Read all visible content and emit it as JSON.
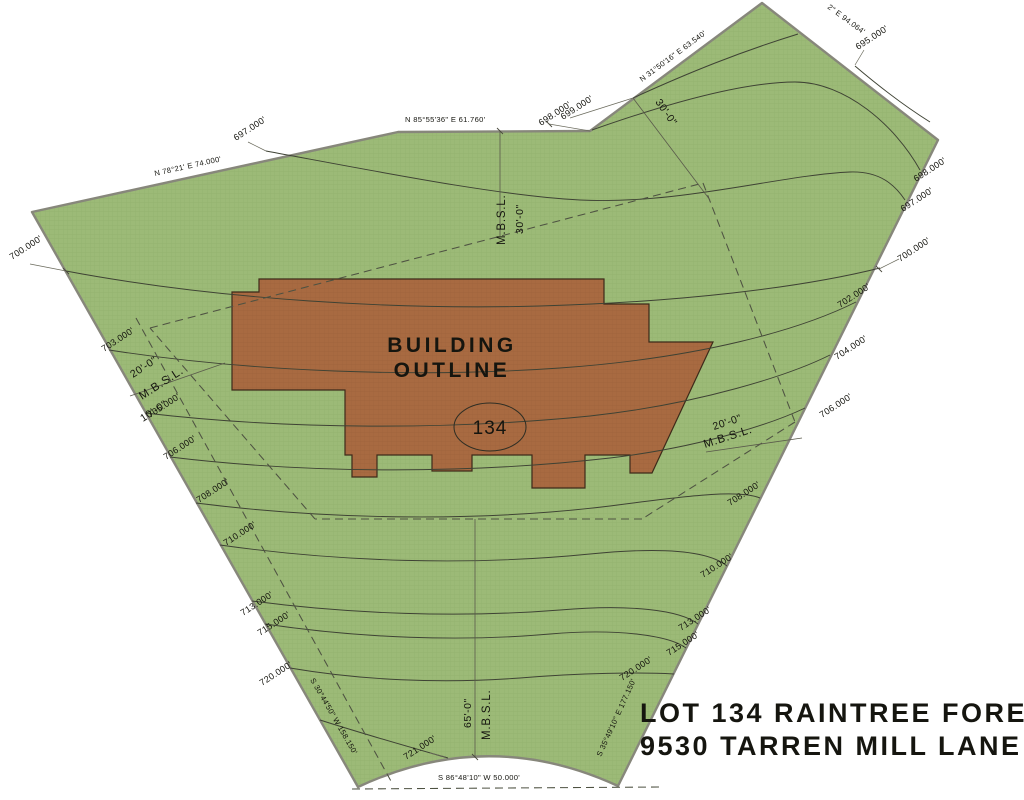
{
  "title": {
    "line1": "LOT 134 RAINTREE FOREST",
    "line2": "9530 TARREN MILL LANE"
  },
  "building": {
    "label_line1": "BUILDING",
    "label_line2": "OUTLINE",
    "lot_number": "134"
  },
  "bearings": {
    "top_left": "N 78°21' E 74.000'",
    "top": "N 85°55'36\" E 61.760'",
    "northeast": "N 31°50'16\" E 63.540'",
    "northeast2": "2\" E 94.064'",
    "right": "S 35°49'10\" E 177.150'",
    "left": "S 30°44'50\" W 158.150'",
    "bottom": "S 86°48'10\" W 50.000'"
  },
  "setbacks": {
    "mbsl": "M.B.S.L.",
    "d30": "30'-0\"",
    "d20": "20'-0\"",
    "d10": "10'-0\"",
    "d65": "65'-0\""
  },
  "contours": {
    "c695": "695.000'",
    "c697": "697.000'",
    "c698": "698.000'",
    "c699": "699.000'",
    "c700": "700.000'",
    "c702": "702.000'",
    "c703": "703.000'",
    "c704": "704.000'",
    "c705": "705.000'",
    "c706": "706.000'",
    "c708": "708.000'",
    "c710": "710.000'",
    "c713": "713.000'",
    "c715": "715.000'",
    "c720": "720.000'",
    "c721": "721.000'"
  },
  "colors": {
    "lot_green": "#9cba77",
    "lot_green_grid": "#8fae69",
    "building_brown": "#a86a41",
    "building_brown_grid": "#9b603a",
    "boundary_gray": "#87877b",
    "contour_dark": "#3e4234"
  }
}
